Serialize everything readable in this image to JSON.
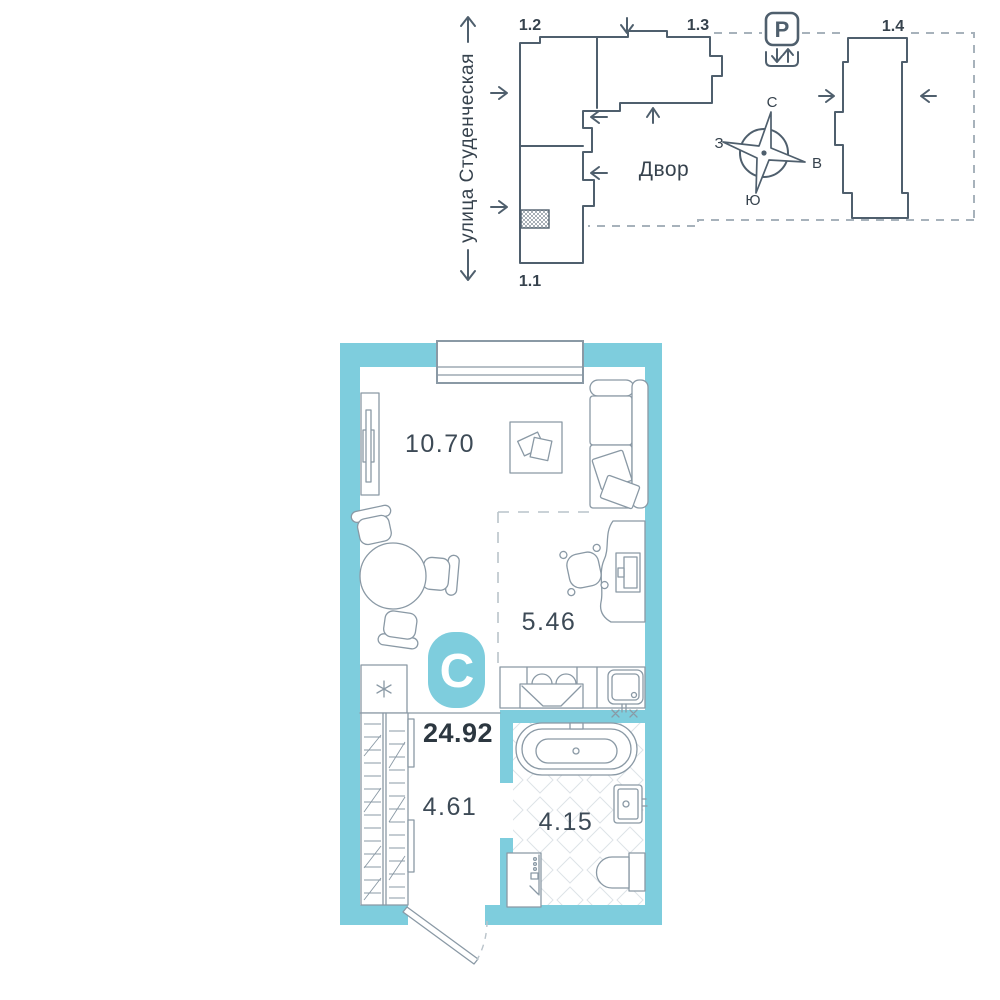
{
  "site_plan": {
    "street_label": "улица Студенческая",
    "courtyard_label": "Двор",
    "parking_label": "P",
    "building_labels": {
      "b11": "1.1",
      "b12": "1.2",
      "b13": "1.3",
      "b14": "1.4"
    },
    "compass": {
      "north": "С",
      "east": "В",
      "south": "Ю",
      "west": "З"
    }
  },
  "floor_plan": {
    "type_badge": "С",
    "total_area": "24.92",
    "room_areas": {
      "living_room": "10.70",
      "kitchen": "5.46",
      "hallway": "4.61",
      "bathroom": "4.15"
    }
  },
  "colors": {
    "wall": "#7ecddd",
    "badge": "#7ecddd",
    "site_line": "#4f5f6d",
    "furniture_line": "#8a99a5",
    "text_dark": "#36424d"
  }
}
